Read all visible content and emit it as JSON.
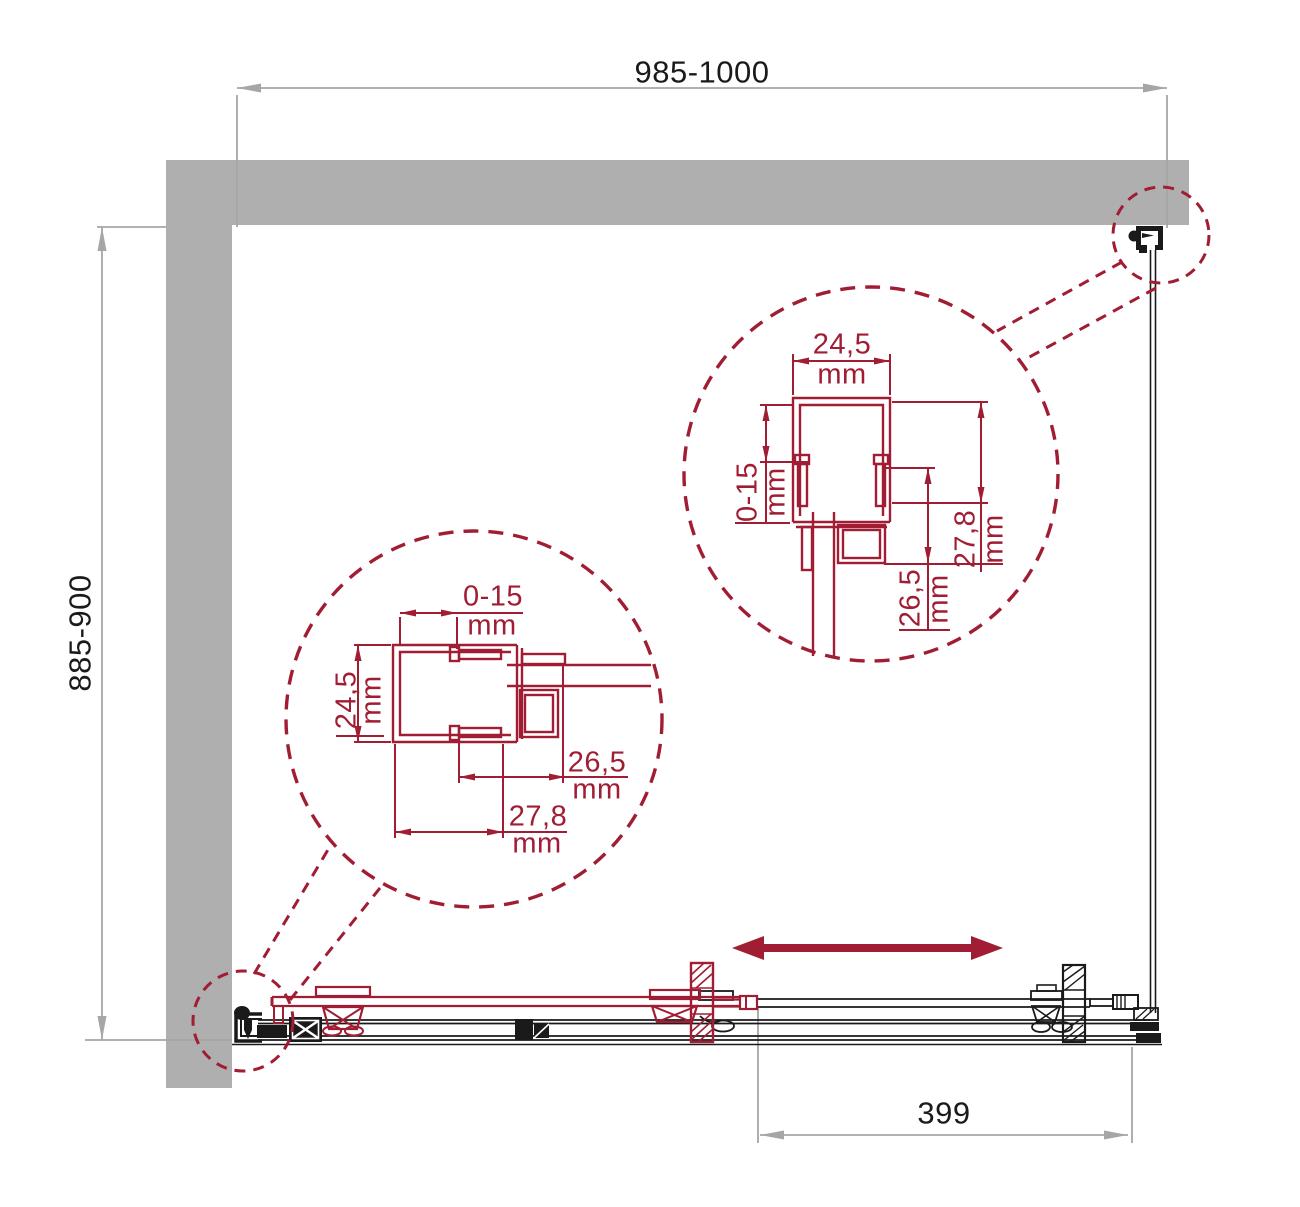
{
  "title": "Shower enclosure installation diagram",
  "units": {
    "mm": "mm"
  },
  "dimensions": {
    "top": "985-1000",
    "left": "885-900",
    "bottom_panel": "399"
  },
  "detail_right": {
    "profile_width": "24,5",
    "glass_adjust": "0-15",
    "profile_depth": "27,8",
    "inner_depth": "26,5"
  },
  "detail_left": {
    "glass_adjust": "0-15",
    "profile_width": "24,5",
    "inner_depth": "26,5",
    "profile_depth": "27,8"
  },
  "icons": {
    "slide_direction": "double-headed-arrow"
  },
  "colors": {
    "accent_red": "#A01D33",
    "wall_gray": "#AFAFB0",
    "dim_gray": "#A6A6A6",
    "ink_black": "#1A1A1A"
  }
}
